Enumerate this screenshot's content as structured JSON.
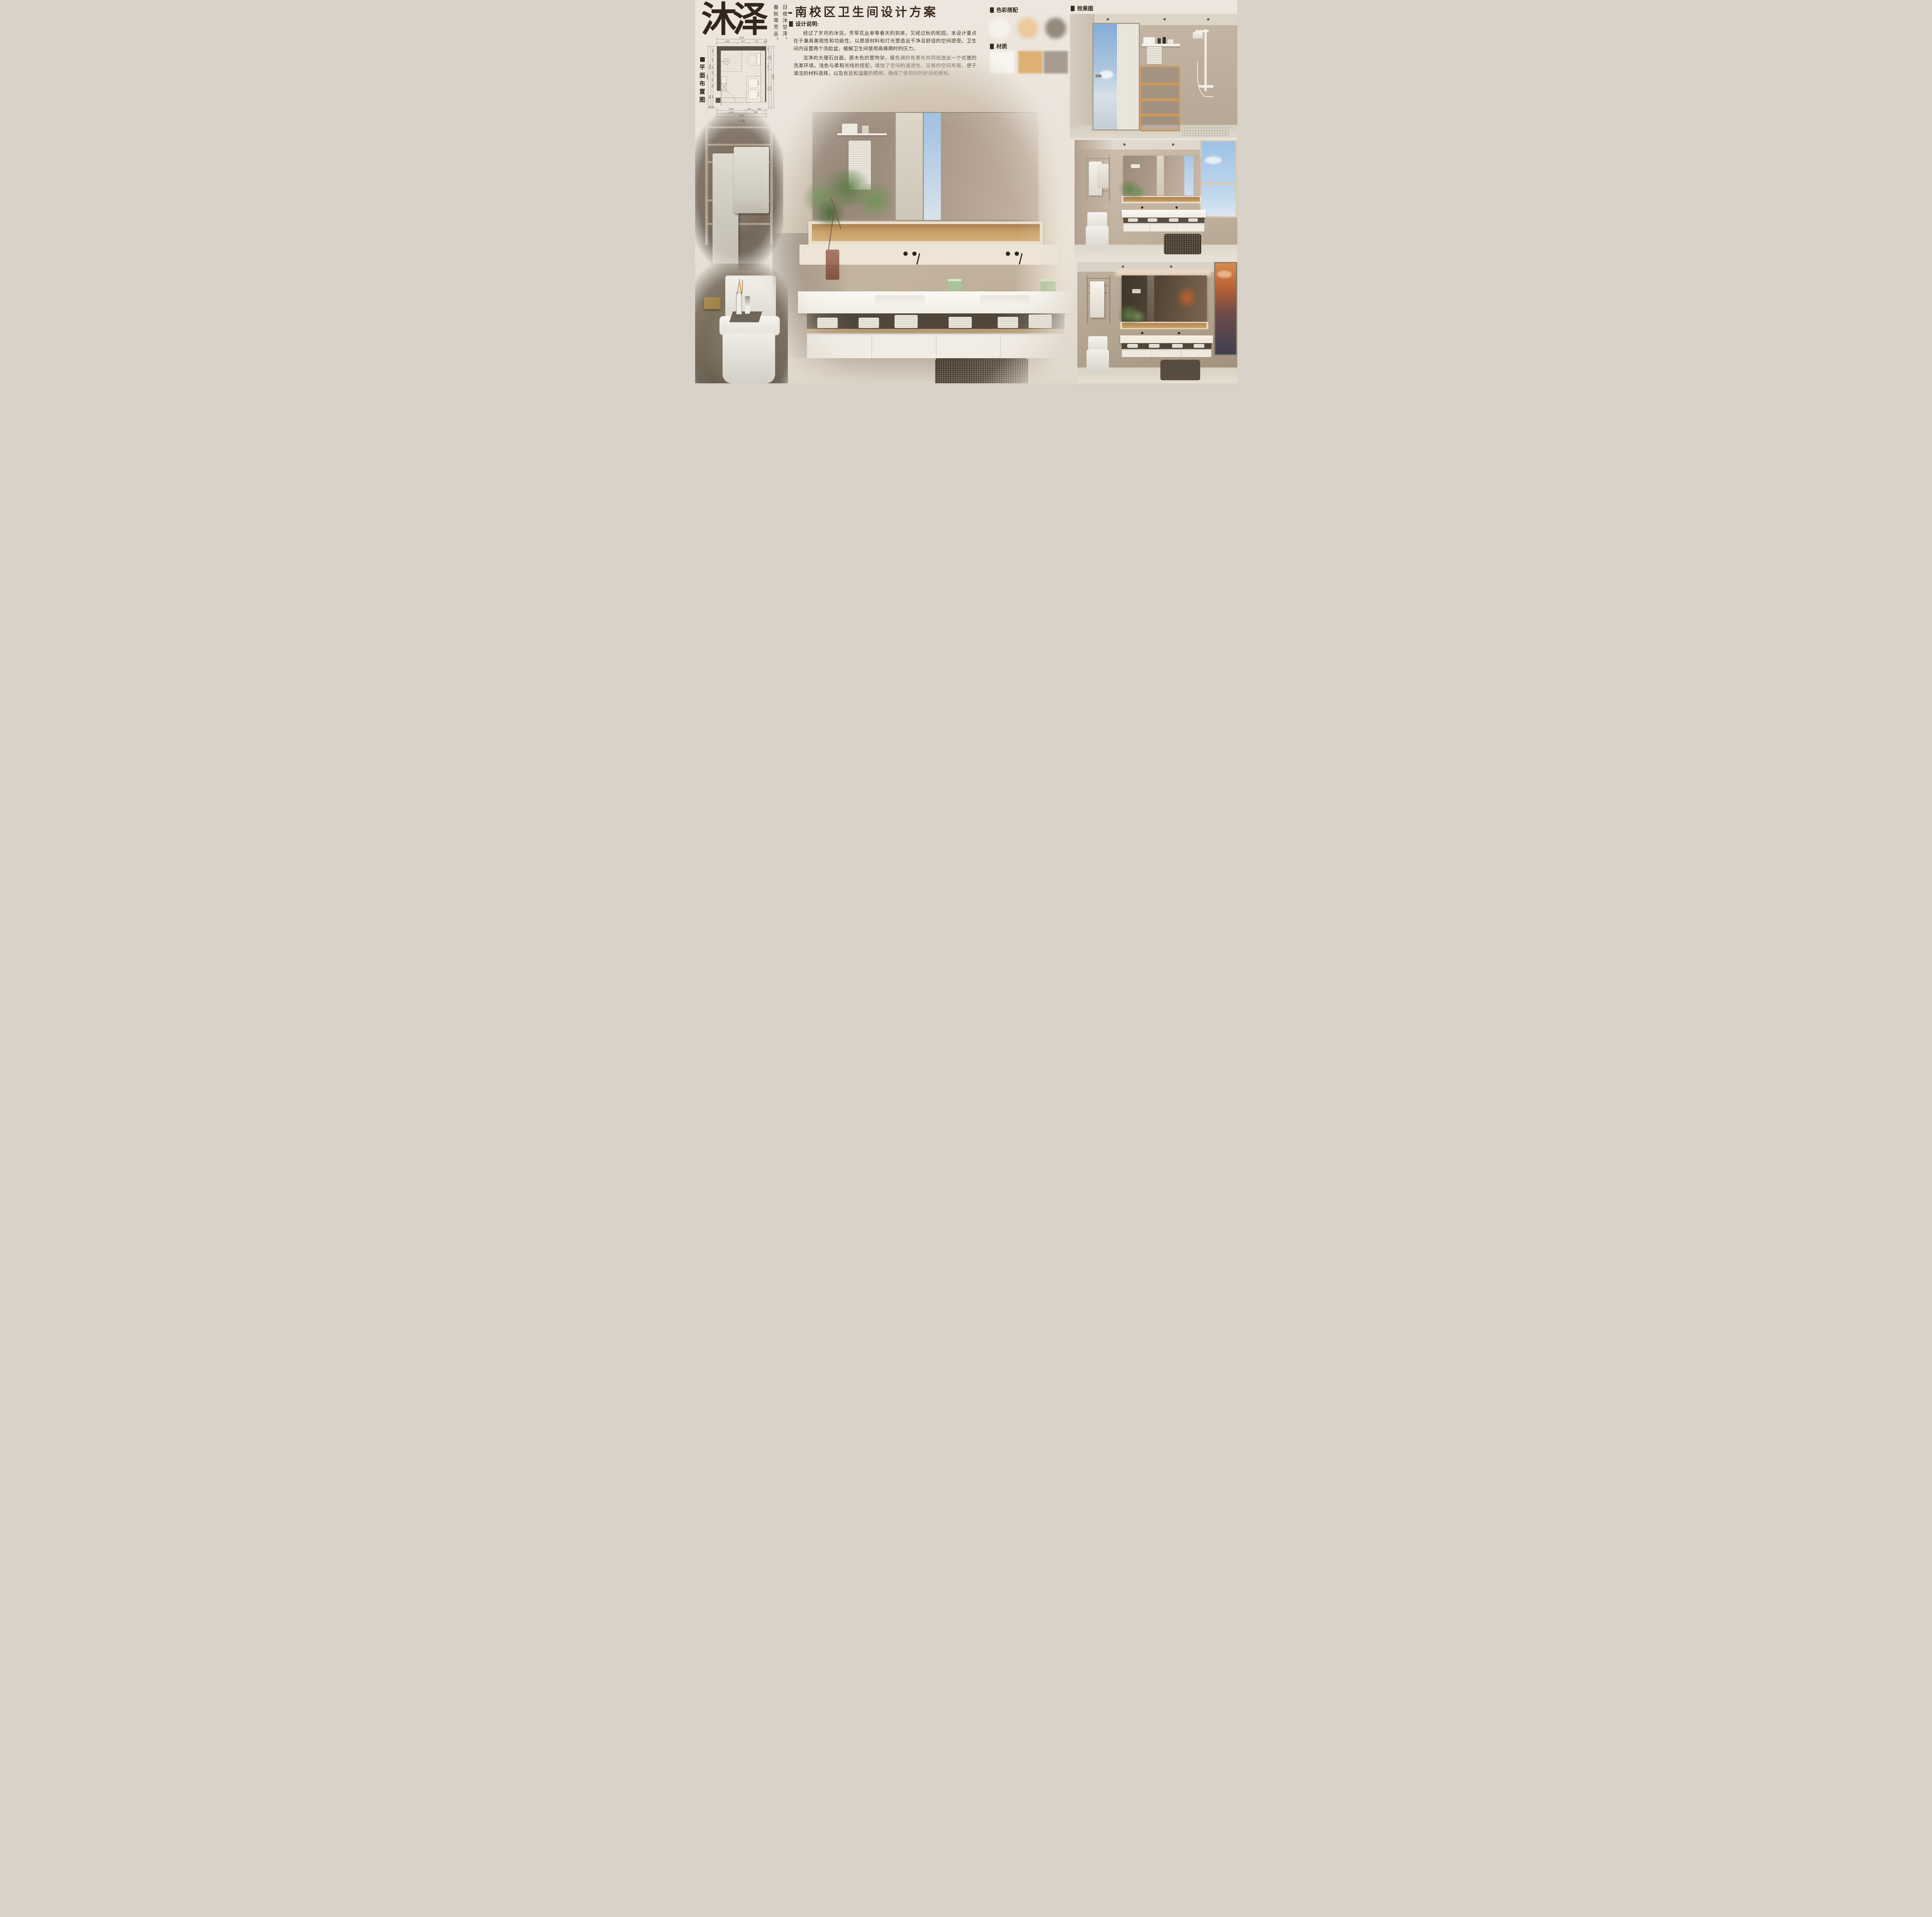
{
  "poster": {
    "background": "#EAE4DB",
    "accent_dark": "#3B2A1A",
    "body_text": "#45331F"
  },
  "brand": {
    "logo": "沐泽",
    "tagline_line1": "日夜沐甘泽，",
    "tagline_line2": "春秋等芳丛。"
  },
  "title": "-南校区卫生间设计方案",
  "design_notes": {
    "heading": "设计说明:",
    "para1": "经过了岁月的沐浴，芳草花丛单等春天的到来，又经过秋的轮回。本设计重点在于兼具美观性和功能性，以质感材料和灯光营造出干净且舒适的空间感受。卫生间内设置两个洗脸盆，缓解卫生间使用高峰期时的压力。",
    "para2": "洁净的大理石台面，原木色的置物架，暖色调的背景光共同创造出一个优雅的洗漱环境。浅色与柔和光线的搭配，增加了空间的通透性。足够的空间布局，便于清洁的材料选择，以及充足和温暖的照明，确保了使用时的舒适和便利。"
  },
  "palette": {
    "label": "色彩搭配",
    "swatches": [
      {
        "name": "warm-white",
        "hex": "#F7F2EB"
      },
      {
        "name": "sand-beige",
        "hex": "#EBCA9E"
      },
      {
        "name": "warm-taupe",
        "hex": "#95897C"
      }
    ]
  },
  "materials": {
    "label": "材质",
    "swatches": [
      {
        "name": "white-marble",
        "hex": "#F8F4EE"
      },
      {
        "name": "light-oak-wood",
        "hex": "#DFAF71"
      },
      {
        "name": "warm-grey-stone",
        "hex": "#A69D90"
      }
    ]
  },
  "renders": {
    "label": "效果图"
  },
  "floor_plan": {
    "label": "平面布置图",
    "scale": "1:30",
    "top_total": "2350",
    "top_segments": [
      "1000",
      "527",
      "723",
      "100"
    ],
    "bottom_row1": [
      "1370",
      "330",
      "650"
    ],
    "bottom_row2": [
      "1370",
      "980"
    ],
    "bottom_total": "2350",
    "left_inner": [
      "400",
      "400",
      "260",
      "200",
      "400",
      "150",
      "800",
      "80"
    ],
    "left_mid": [
      "1810",
      "800",
      "80"
    ],
    "left_total": "2690",
    "right_inner": [
      "255",
      "511",
      "255",
      "1670"
    ],
    "right_mid": [
      "1020",
      "1670"
    ],
    "right_total": "2690"
  }
}
